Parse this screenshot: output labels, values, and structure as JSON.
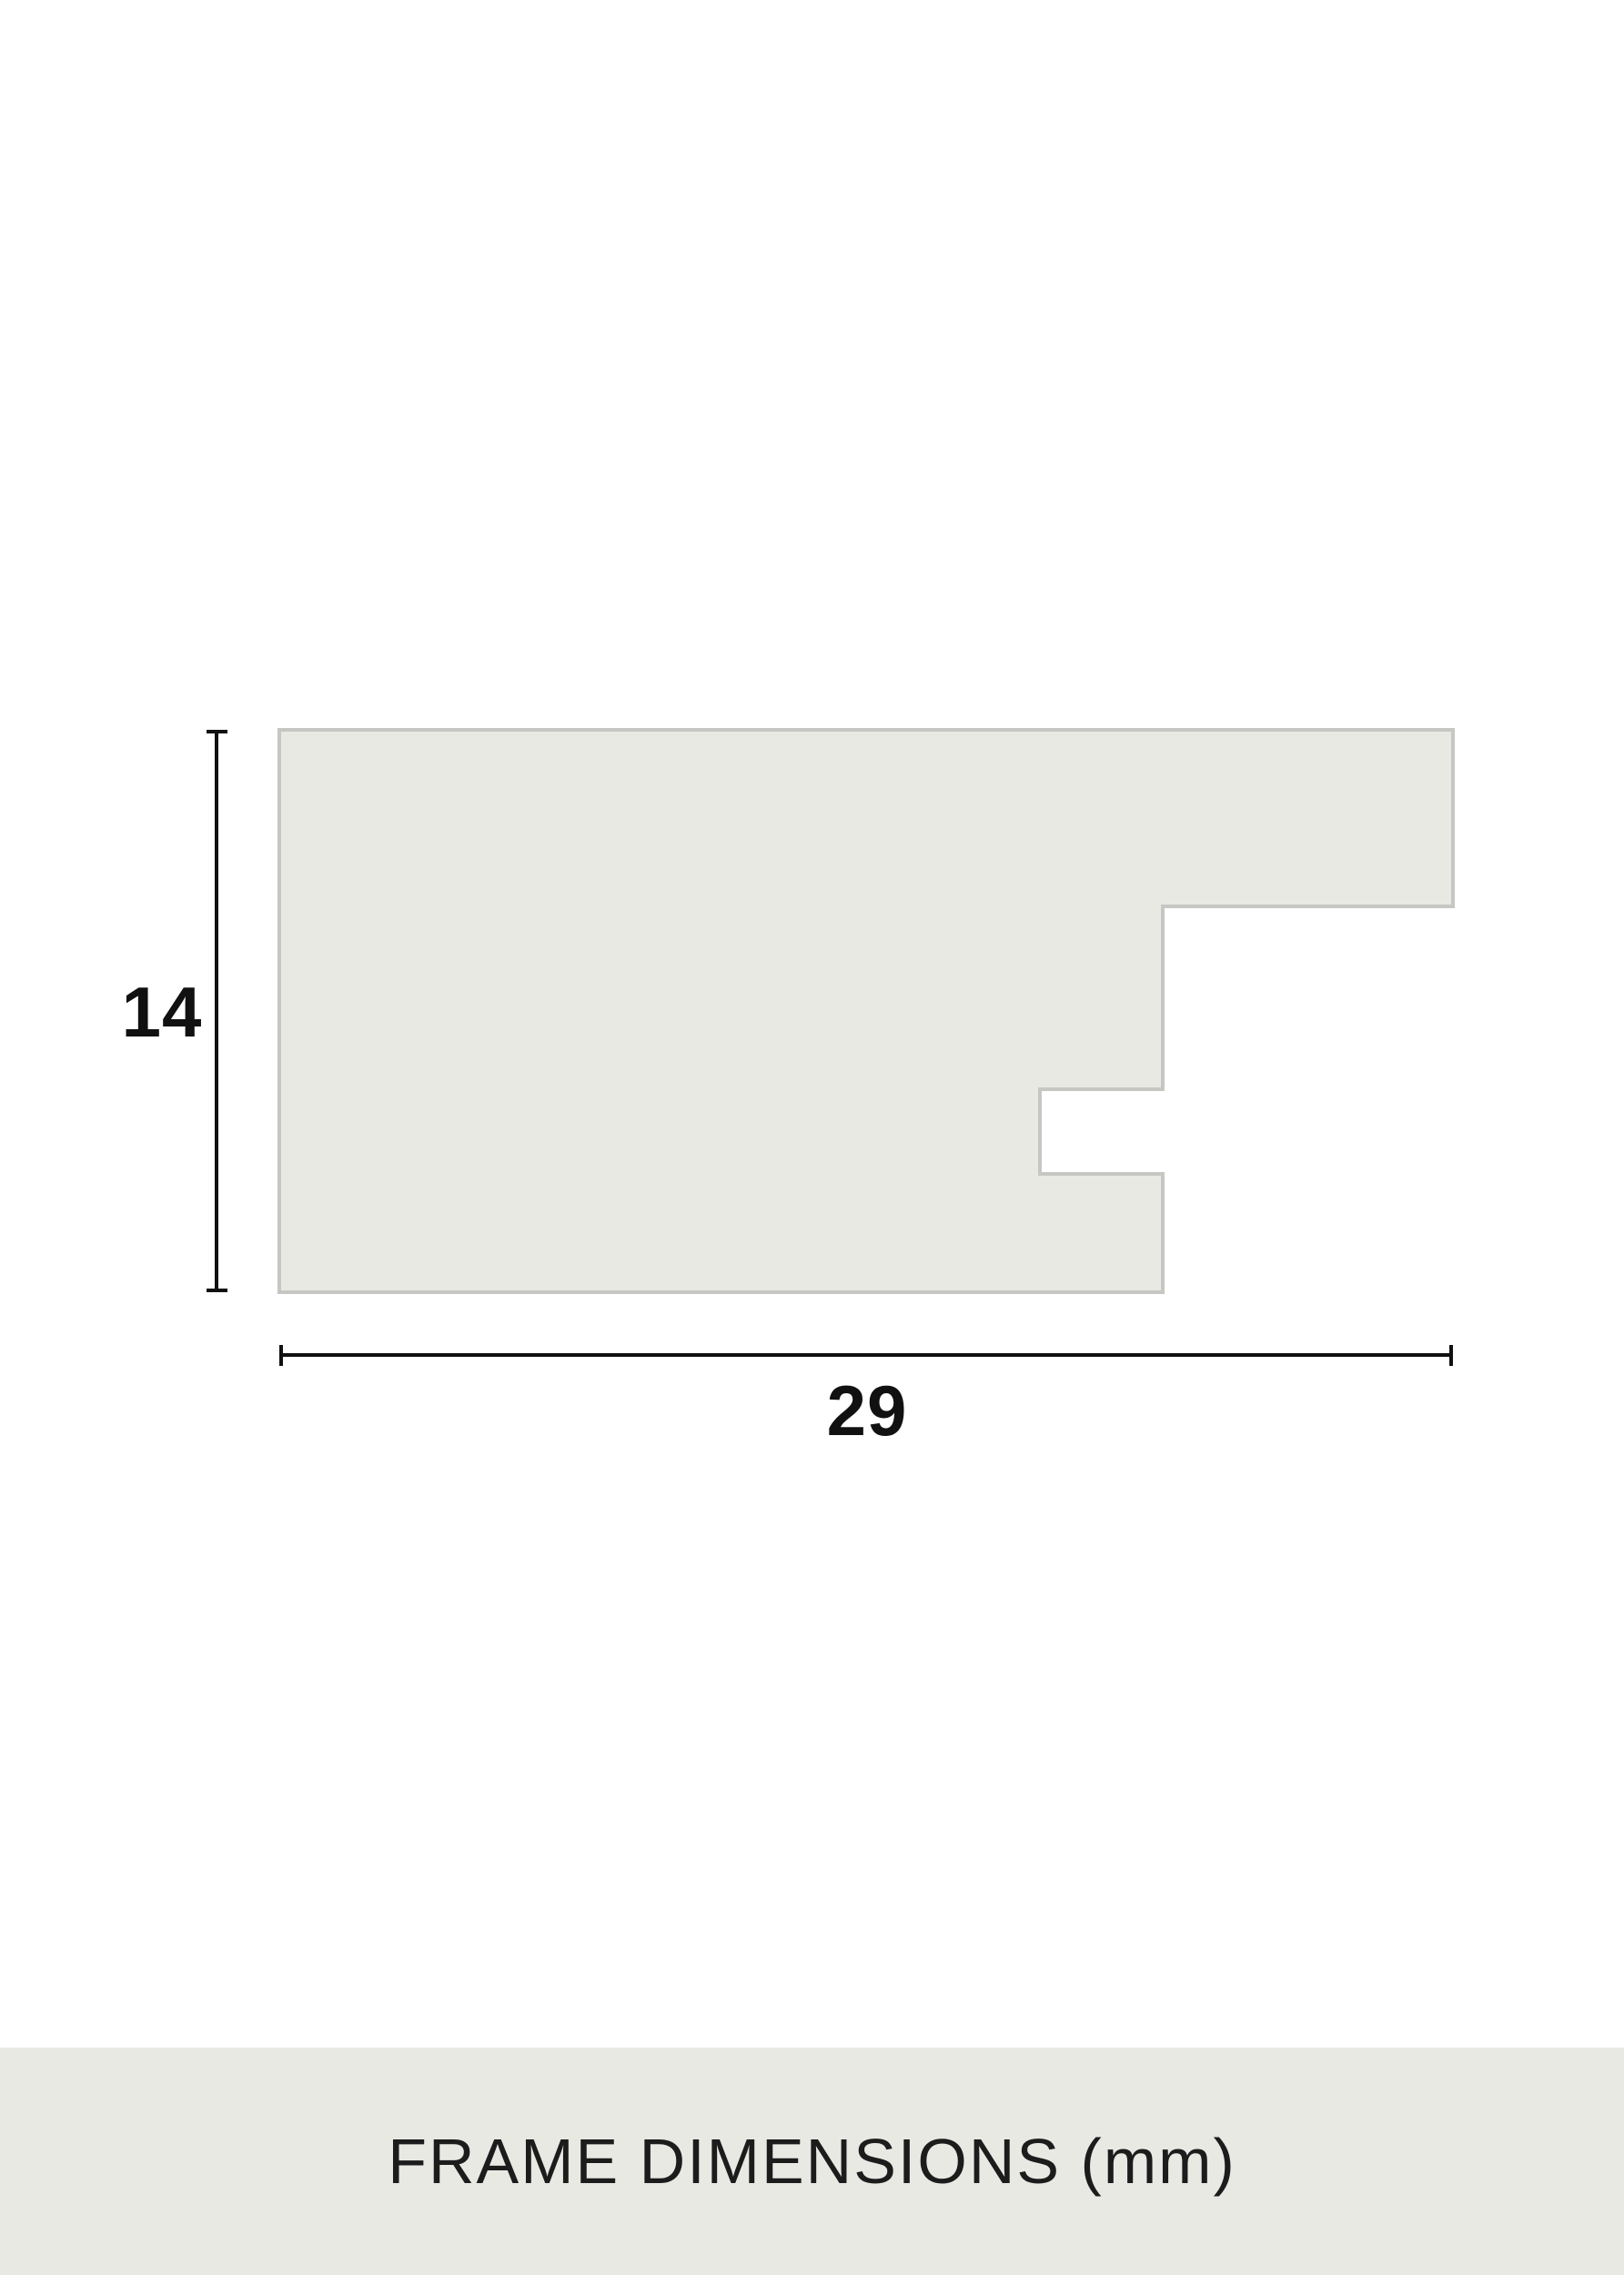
{
  "diagram": {
    "height_mm": "14",
    "width_mm": "29",
    "caption": "FRAME DIMENSIONS (mm)",
    "unit": "mm",
    "profile_points": "307,802 1597,802 1597,996 1278,996 1278,1197 1143,1197 1143,1290 1278,1290 1278,1420 307,1420",
    "colors": {
      "background": "#ffffff",
      "profile_fill": "#e9e9e4",
      "profile_stroke": "#c6c6c3",
      "dimension_line": "#111111",
      "label_text": "#111111",
      "caption_band": "#e9e9e4",
      "caption_text": "#1c1c1c"
    }
  }
}
